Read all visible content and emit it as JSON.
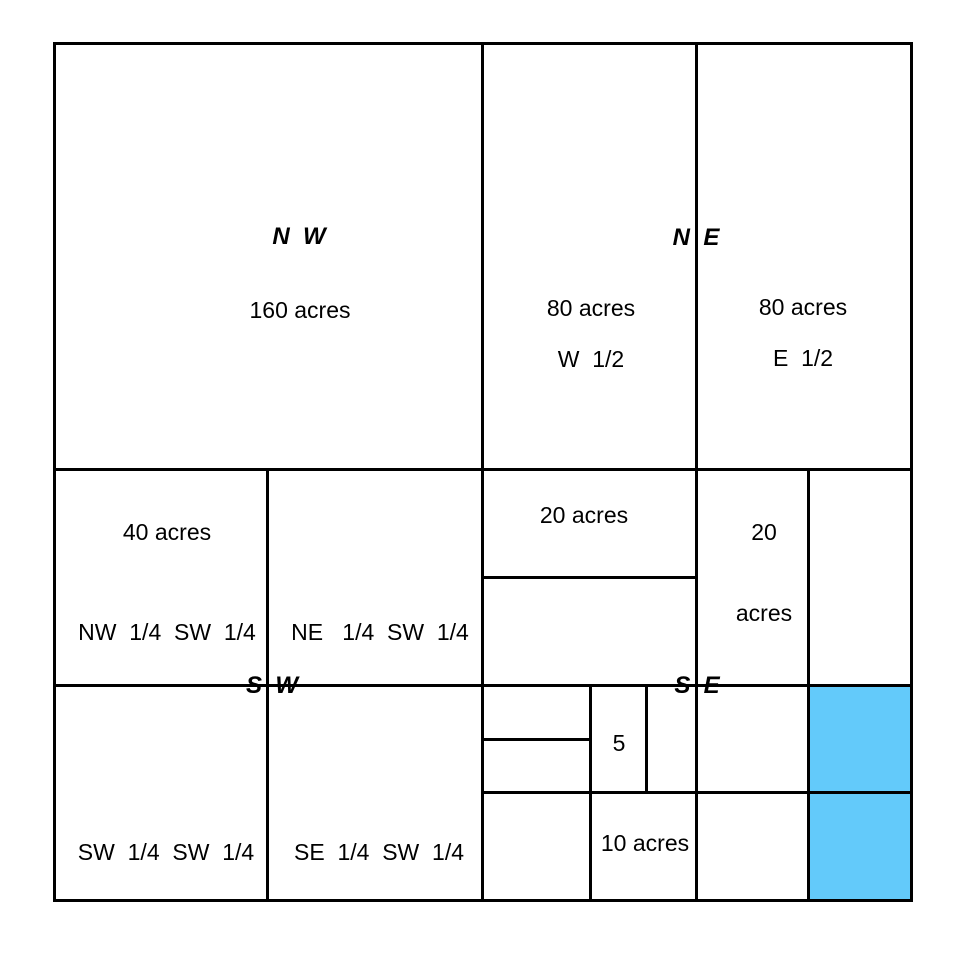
{
  "colors": {
    "line": "#000000",
    "text": "#000000",
    "background": "#FFFFFF",
    "highlight": "#63CAFA"
  },
  "section": {
    "nw": {
      "label": "N  W",
      "area": "160 acres"
    },
    "ne": {
      "label": "N  E",
      "west_half": {
        "area": "80 acres",
        "name": "W  1/2"
      },
      "east_half": {
        "area": "80 acres",
        "name": "E  1/2"
      }
    },
    "sw": {
      "label": "S  W",
      "nw_quarter": {
        "area": "40 acres",
        "name": "NW  1/4  SW  1/4"
      },
      "ne_quarter": {
        "name": "NE   1/4  SW  1/4"
      },
      "sw_quarter": {
        "name": "SW  1/4  SW  1/4"
      },
      "se_quarter": {
        "name": "SE  1/4  SW  1/4"
      }
    },
    "se": {
      "label": "S  E",
      "north_west_parcel": {
        "area": "20 acres"
      },
      "north_east_parcel": {
        "area_line1": "20",
        "area_line2": "acres"
      },
      "five_acre_parcel": {
        "area": "5"
      },
      "ten_acre_parcel": {
        "area": "10 acres"
      }
    }
  }
}
